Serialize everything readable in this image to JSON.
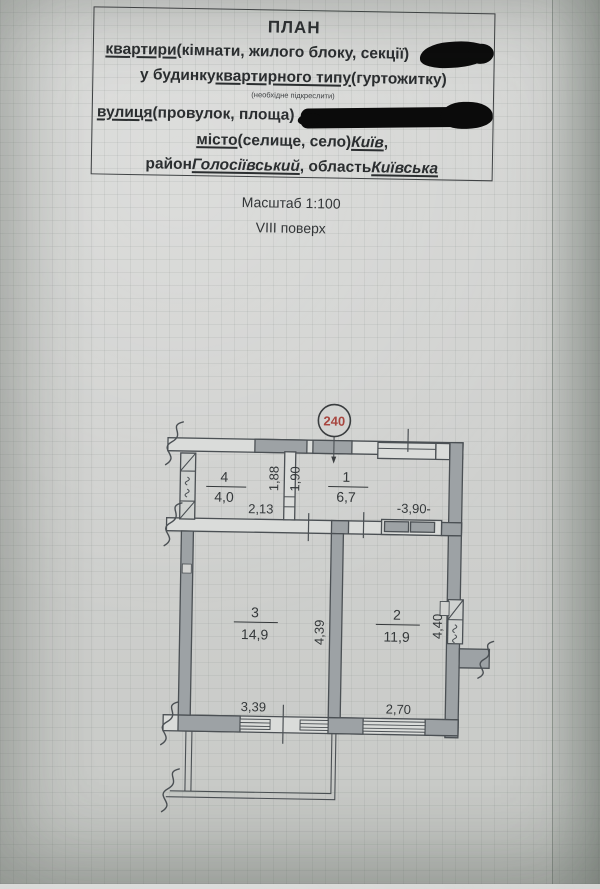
{
  "header": {
    "title": "ПЛАН",
    "line2_underlined": "квартири",
    "line2_rest": " (кімнати, жилого блоку, секції)",
    "line3_start": "у будинку ",
    "line3_underlined": "квартирного типу",
    "line3_rest": " (гуртожитку)",
    "note": "(необхідне підкреслити)",
    "line5_underlined": "вулиця",
    "line5_rest": " (провулок, площа)",
    "line6_underlined": "місто",
    "line6_mid": " (селище, село) ",
    "line6_city": "Київ",
    "line6_end": ",",
    "line7_start": "район ",
    "line7_district": "Голосіївський",
    "line7_mid": ", область ",
    "line7_region": "Київська"
  },
  "meta": {
    "scale": "Масштаб 1:100",
    "floor": "VIII поверх"
  },
  "plan": {
    "apartment_number": "240",
    "number_color": "#a8463f",
    "rooms": [
      {
        "number": "1",
        "area": "6,7"
      },
      {
        "number": "2",
        "area": "11,9"
      },
      {
        "number": "3",
        "area": "14,9"
      },
      {
        "number": "4",
        "area": "4,0"
      }
    ],
    "dimensions": {
      "room4_width": "2,13",
      "hall_depth_left": "1,88",
      "hall_depth_right": "1,90",
      "hall_length": "-3,90-",
      "room3_depth": "4,39",
      "room2_depth": "4,40",
      "room3_width": "3,39",
      "room2_width": "2,70"
    }
  }
}
